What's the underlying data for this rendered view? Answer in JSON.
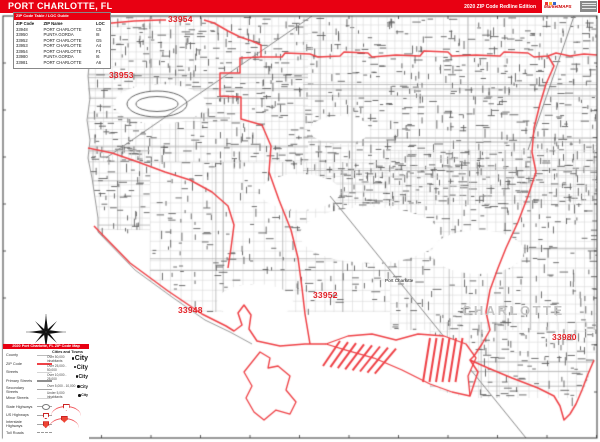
{
  "header": {
    "title": "PORT CHARLOTTE, FL",
    "edition": "2020 ZIP Code Redline Edition",
    "brand": "MarketMAPS"
  },
  "zip_table": {
    "title": "ZIP Code Table / LOC Guide",
    "columns": [
      "ZIP Code",
      "ZIP Name",
      "LOC"
    ],
    "rows": [
      [
        "33948",
        "PORT CHARLOTTE",
        "C5"
      ],
      [
        "33950",
        "PUNTA GORDA",
        "I8"
      ],
      [
        "33952",
        "PORT CHARLOTTE",
        "G5"
      ],
      [
        "33953",
        "PORT CHARLOTTE",
        "A4"
      ],
      [
        "33954",
        "PORT CHARLOTTE",
        "F1"
      ],
      [
        "33980",
        "PUNTA GORDA",
        "I6"
      ],
      [
        "33981",
        "PORT CHARLOTTE",
        "A6"
      ]
    ]
  },
  "map": {
    "zip_labels": {
      "z33954": "33954",
      "z33953": "33953",
      "z33948": "33948",
      "z33952": "33952",
      "z33980": "33980"
    },
    "places": {
      "port_charlotte": "Port Charlotte",
      "county": "CHARLOTTE"
    }
  },
  "legend": {
    "title": "2020 Port Charlotte, FL ZIP Code Map",
    "items": [
      "County",
      "ZIP Code",
      "Streets",
      "Primary Streets",
      "Secondary Streets",
      "Minor Streets",
      "State Highways",
      "US Highways",
      "Interstate Highways",
      "Toll Roads"
    ],
    "cities_header": "Cities and Towns",
    "city_rows": [
      {
        "range": "Over 50,000 inhabitants",
        "name": "City"
      },
      {
        "range": "Over 25,000 - 50,000",
        "name": "City"
      },
      {
        "range": "Over 10,000 - 25,000",
        "name": "City"
      },
      {
        "range": "Over 5,000 - 10,000",
        "name": "City"
      },
      {
        "range": "Under 5,000 inhabitants",
        "name": "City"
      }
    ]
  },
  "colors": {
    "bar_red": "#e80012",
    "boundary_red": "#ef4146",
    "zip_label_red": "#e32127",
    "county_text": "#c4c4c4"
  }
}
